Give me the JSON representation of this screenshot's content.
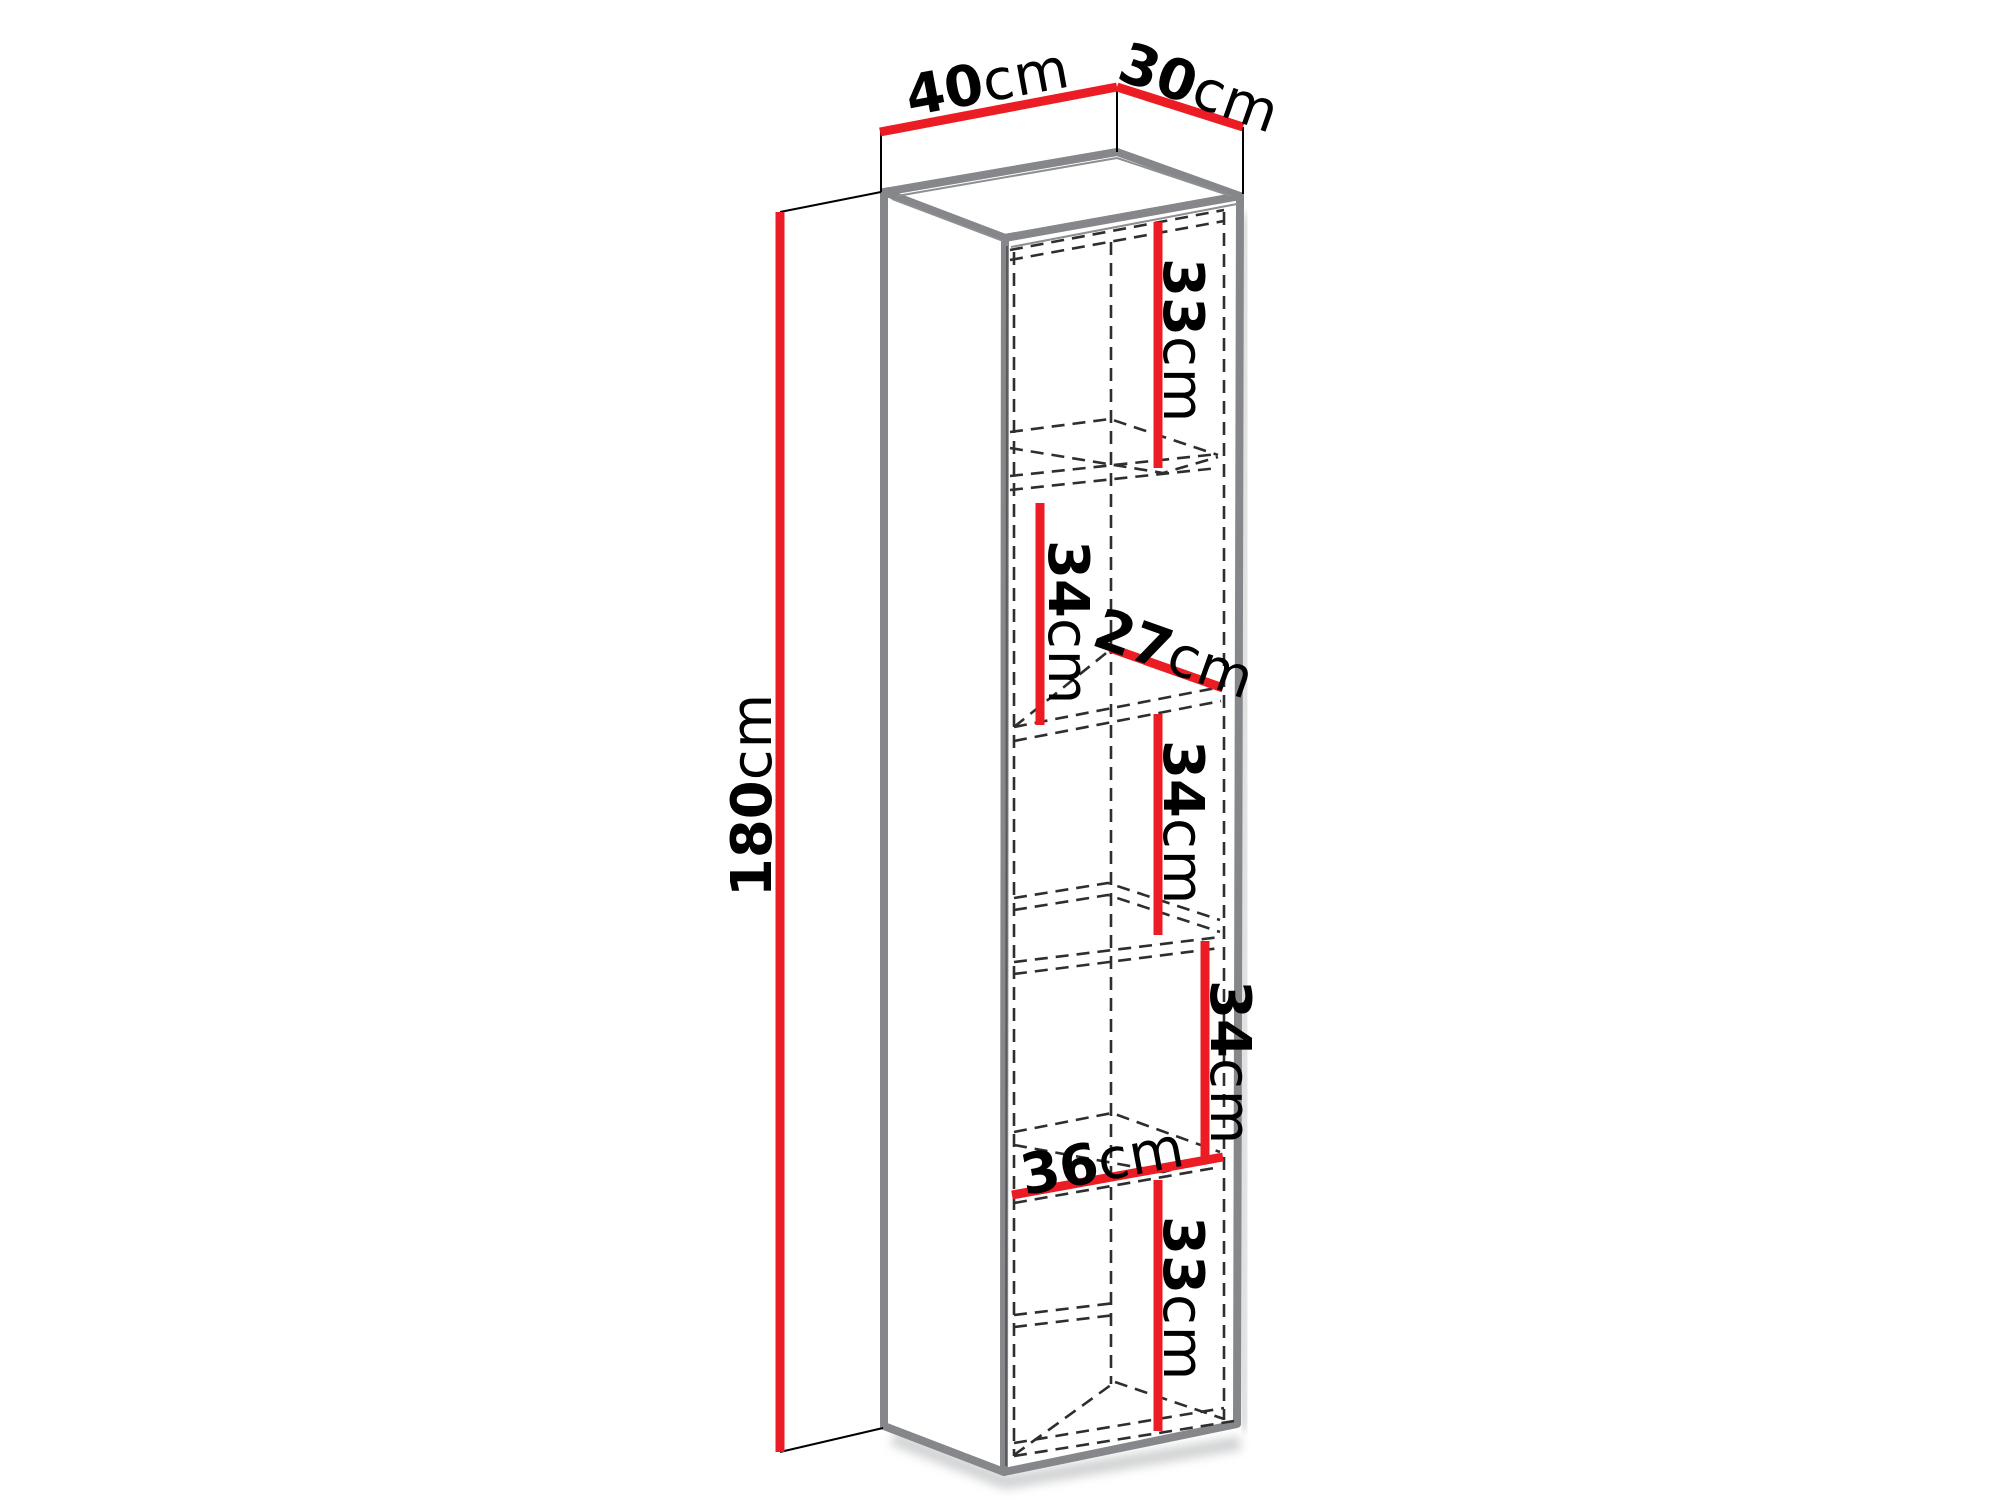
{
  "diagram": {
    "type": "furniture-dimension-diagram",
    "subject": "tall wall cabinet with five compartments",
    "colors": {
      "background": "#ffffff",
      "dimension_line": "#ec1c24",
      "cabinet_outline": "#85878a",
      "hidden_edge_dash": "#2e2e2e",
      "extension_line": "#000000",
      "label_text": "#000000"
    },
    "dimensions": {
      "width": {
        "value": "40",
        "unit": "cm"
      },
      "depth": {
        "value": "30",
        "unit": "cm"
      },
      "height": {
        "value": "180",
        "unit": "cm"
      },
      "inner_depth": {
        "value": "27",
        "unit": "cm"
      },
      "inner_width": {
        "value": "36",
        "unit": "cm"
      },
      "compartments": [
        {
          "value": "33",
          "unit": "cm"
        },
        {
          "value": "34",
          "unit": "cm"
        },
        {
          "value": "34",
          "unit": "cm"
        },
        {
          "value": "34",
          "unit": "cm"
        },
        {
          "value": "33",
          "unit": "cm"
        }
      ]
    }
  }
}
